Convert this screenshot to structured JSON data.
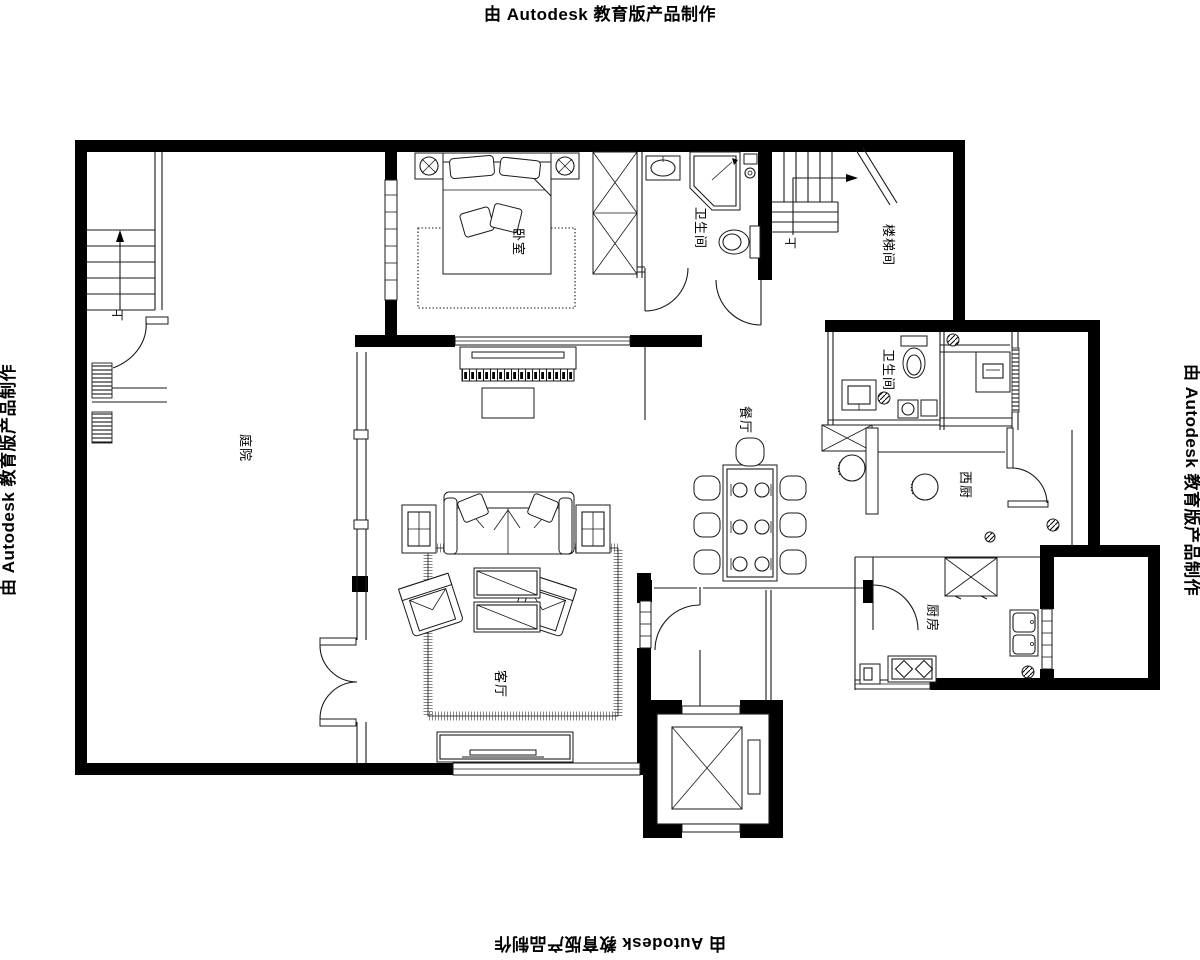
{
  "edge_labels": {
    "top": "由 Autodesk 教育版产品制作",
    "bottom": "由 Autodesk 教育版产品制作",
    "left": "由 Autodesk 教育版产品制作",
    "right": "由 Autodesk 教育版产品制作"
  },
  "rooms": {
    "courtyard": "庭院",
    "bedroom": "卧室",
    "bathroom_top": "卫生间",
    "stairwell": "楼梯间",
    "bathroom_mid": "卫生间",
    "dining": "餐厅",
    "west_kitchen": "西厨",
    "kitchen": "厨房",
    "living": "客厅"
  },
  "stairs": {
    "up_left": "上",
    "up_right": "上"
  },
  "colors": {
    "wall": "#000000",
    "line": "#1a1a1a",
    "background": "#ffffff"
  }
}
